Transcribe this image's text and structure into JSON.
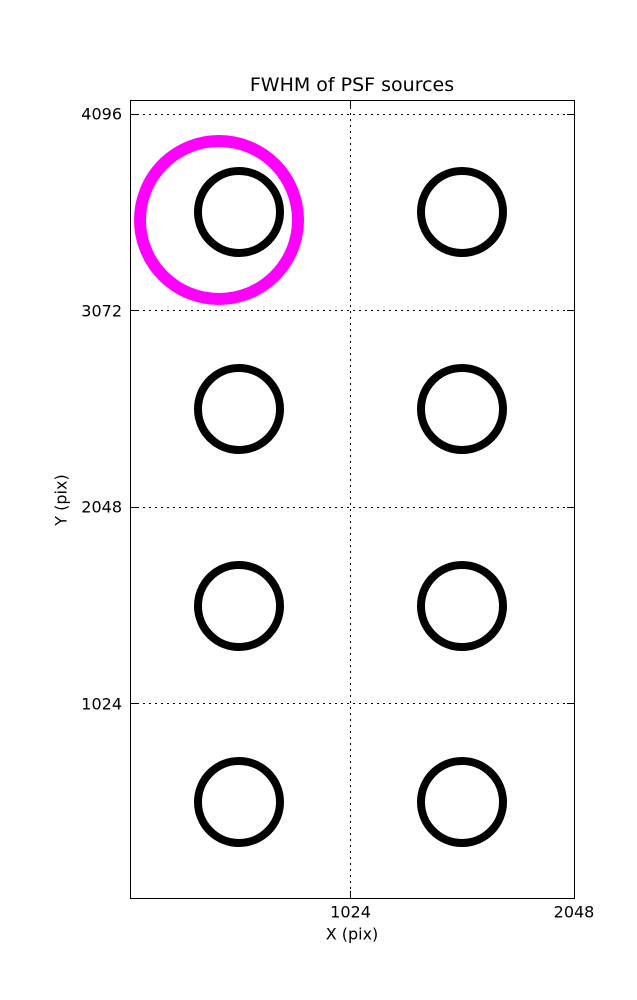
{
  "figure": {
    "background": "#ffffff"
  },
  "chart_data": {
    "type": "scatter",
    "title": "FWHM of PSF sources",
    "xlabel": "X (pix)",
    "ylabel": "Y (pix)",
    "xlim": [
      18,
      2048
    ],
    "ylim": [
      13,
      4164
    ],
    "xticks": [
      1024,
      2048
    ],
    "yticks": [
      1024,
      2048,
      3072,
      4096
    ],
    "grid": "dotted",
    "grid_color": "#000000",
    "axes_color": "#000000",
    "legend": "none",
    "series": [
      {
        "name": "psf-sources",
        "marker": "open-circle",
        "color": "#000000",
        "marker_diameter_px": 90,
        "stroke_px": 8,
        "points": [
          {
            "x": 512,
            "y": 3584
          },
          {
            "x": 1536,
            "y": 3584
          },
          {
            "x": 512,
            "y": 2560
          },
          {
            "x": 1536,
            "y": 2560
          },
          {
            "x": 512,
            "y": 1536
          },
          {
            "x": 1536,
            "y": 1536
          },
          {
            "x": 512,
            "y": 512
          },
          {
            "x": 1536,
            "y": 512
          }
        ]
      },
      {
        "name": "highlighted-source",
        "marker": "open-circle",
        "color": "#ff00ff",
        "marker_diameter_px": 170,
        "stroke_px": 12,
        "points": [
          {
            "x": 420,
            "y": 3545
          }
        ]
      }
    ]
  }
}
